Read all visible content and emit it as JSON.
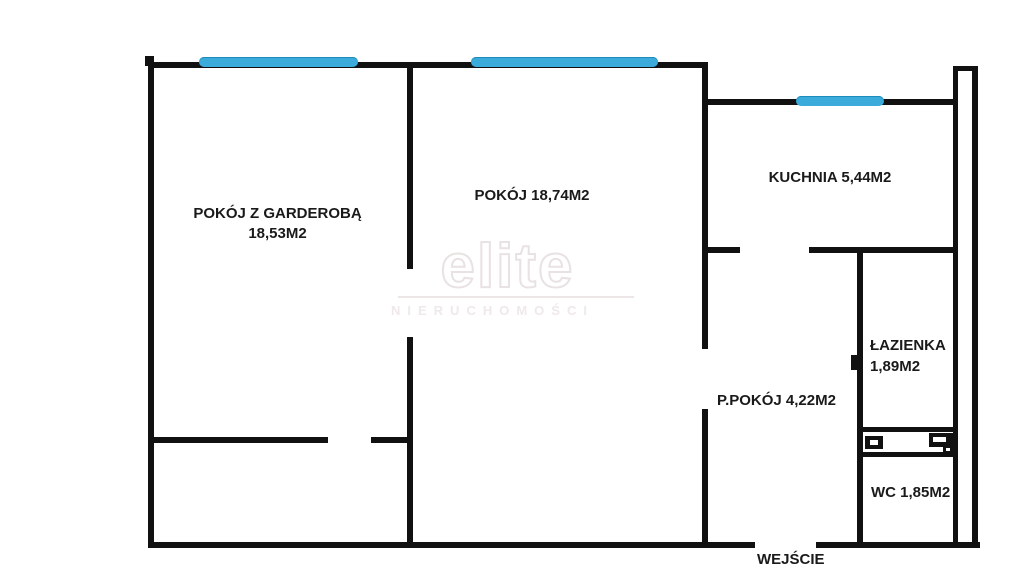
{
  "plan_title": "apartment-floor-plan",
  "labels": {
    "room1_line1": "POKÓJ Z GARDEROBĄ",
    "room1_line2": "18,53M2",
    "room2": "POKÓJ 18,74M2",
    "kitchen": "KUCHNIA 5,44M2",
    "bathroom_line1": "ŁAZIENKA",
    "bathroom_line2": "1,89M2",
    "hall": "P.POKÓJ 4,22M2",
    "wc": "WC 1,85M2",
    "entrance": "WEJŚCIE"
  },
  "watermark": {
    "brand": "elite",
    "subtitle": "NIERUCHOMOŚCI"
  },
  "colors": {
    "background": "#ffffff",
    "wall": "#111111",
    "window": "#3aabdb",
    "watermark_text": "#e9e2e2"
  },
  "windows_count": 3,
  "rooms_count": 6
}
